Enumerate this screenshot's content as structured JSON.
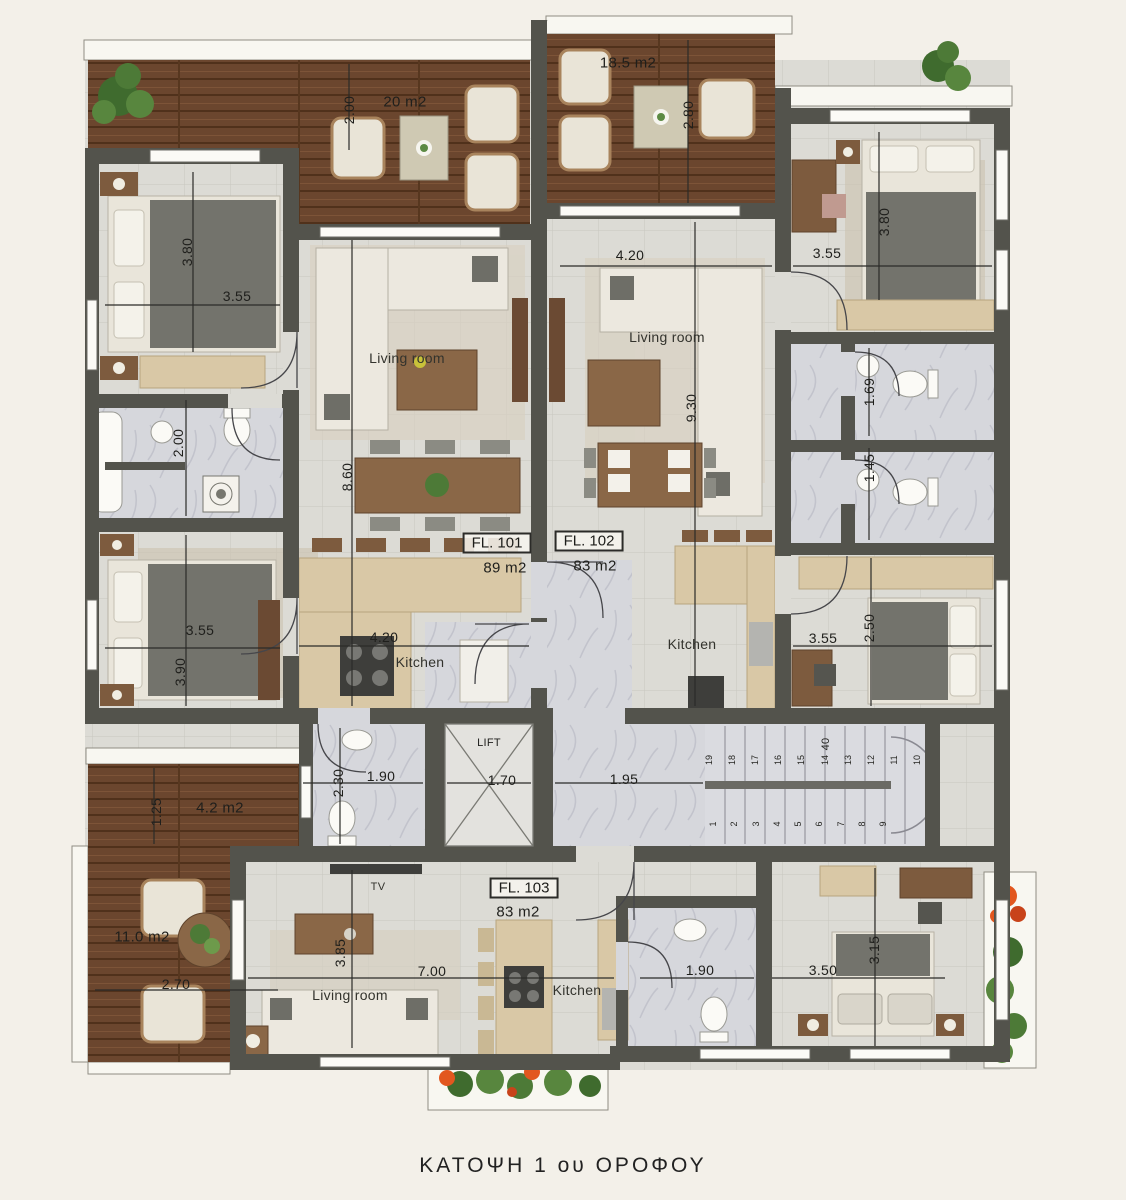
{
  "title": "ΚΑΤΟΨΗ  1 ου ΟΡΟΦΟΥ",
  "apartments": {
    "fl101": {
      "id": "FL. 101",
      "area": "89 m2"
    },
    "fl102": {
      "id": "FL. 102",
      "area": "83 m2"
    },
    "fl103": {
      "id": "FL. 103",
      "area": "83 m2"
    }
  },
  "rooms": {
    "living_fl101": "Living room",
    "living_fl102": "Living room",
    "living_fl103": "Living room",
    "kitchen_fl101": "Kitchen",
    "kitchen_fl102": "Kitchen",
    "kitchen_fl103": "Kitchen",
    "tv": "TV",
    "lift": "LIFT"
  },
  "terraces": {
    "top_left": "20 m2",
    "top_right": "18.5 m2",
    "mid_left": "4.2 m2",
    "bottom_left": "11.0 m2"
  },
  "dimensions": {
    "terrace_tl_depth": "2.00",
    "terrace_tr_depth": "2.80",
    "bed1_width": "3.55",
    "bed1_depth": "3.80",
    "living101_depth": "8.60",
    "kitchen101_width": "4.20",
    "living102_width": "4.20",
    "living102_depth": "9.30",
    "bed_tr_width": "3.55",
    "bed_tr_depth": "3.80",
    "bath_r1_depth": "1.69",
    "bath_r2_depth": "1.45",
    "bed2_width": "3.55",
    "bed2_depth": "3.90",
    "bath_left_depth": "2.00",
    "bed_mr_width": "3.55",
    "bed_mr_depth": "2.50",
    "bath_center_depth": "2.30",
    "bath_center_width": "1.90",
    "lift_width": "1.70",
    "corridor_width": "1.95",
    "terrace_ml_depth": "1.25",
    "terrace_bl_width": "2.70",
    "living103_width": "7.00",
    "living103_depth": "3.85",
    "bath103_width": "1.90",
    "bed_br_width": "3.50",
    "bed_br_depth": "3.15"
  },
  "stairs": {
    "upper_steps": [
      "19",
      "18",
      "17",
      "16",
      "15",
      "14",
      "13",
      "12",
      "11",
      "10"
    ],
    "lower_steps": [
      "1",
      "2",
      "3",
      "4",
      "5",
      "6",
      "7",
      "8",
      "9"
    ],
    "width_note": "40"
  }
}
